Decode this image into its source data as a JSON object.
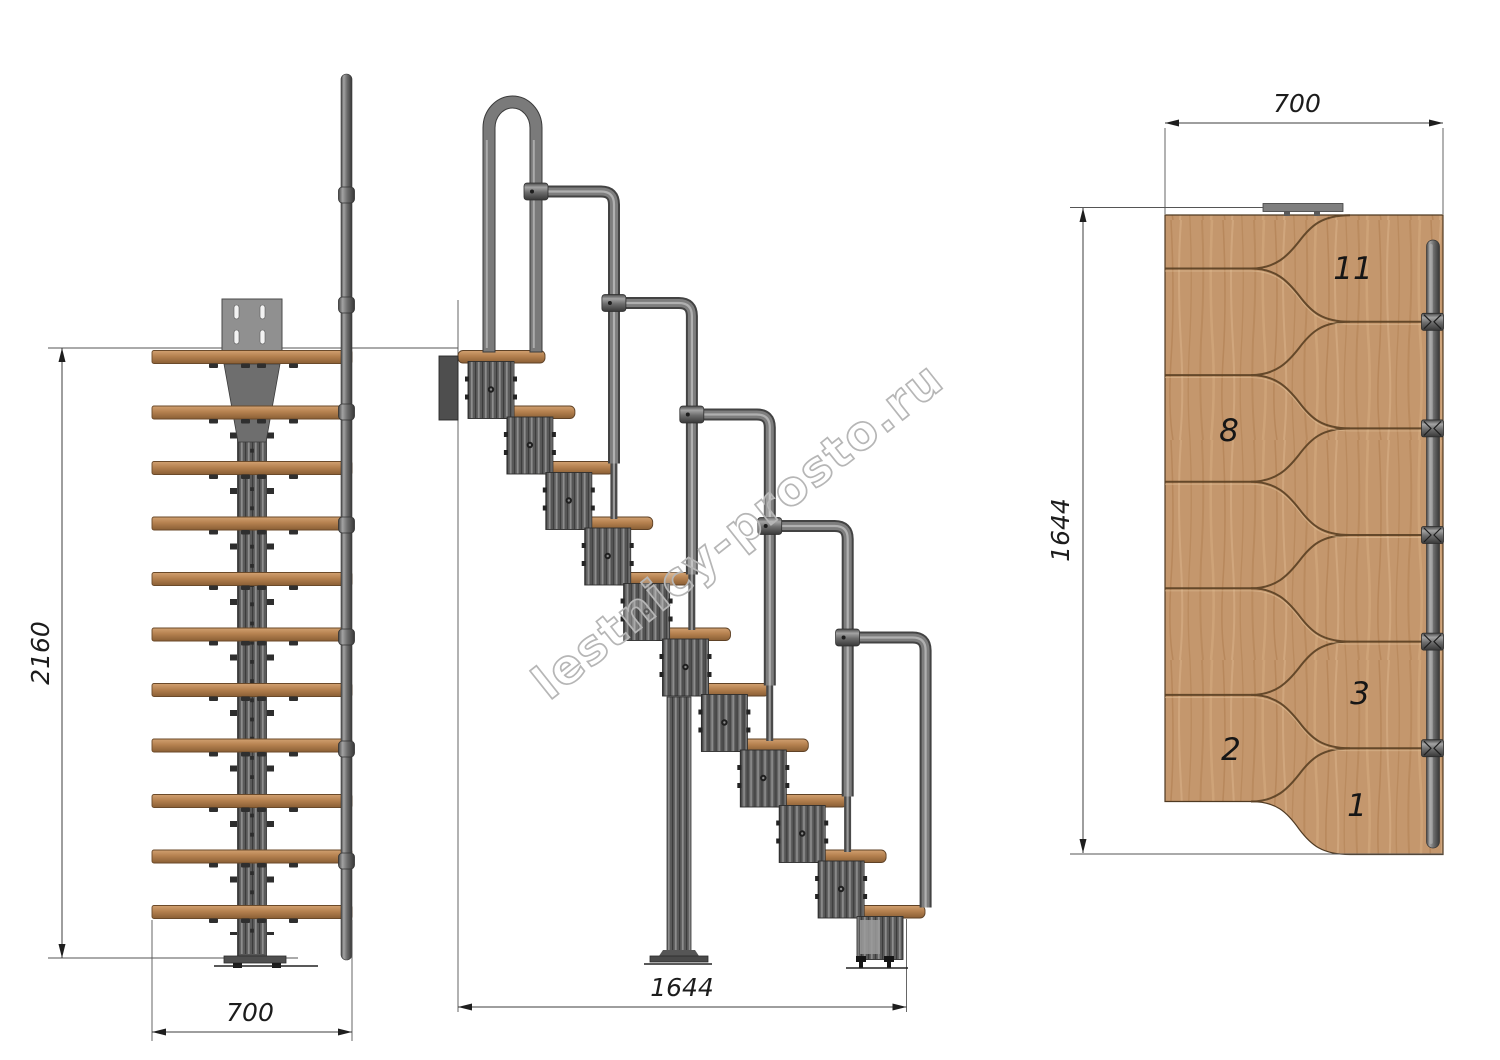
{
  "watermark": {
    "text": "lestnicy-prosto.ru"
  },
  "front_view": {
    "height_dim": "2160",
    "width_dim": "700"
  },
  "side_view": {
    "length_dim": "1644"
  },
  "plan_view": {
    "width_dim": "700",
    "length_dim": "1644",
    "tread_labels": [
      "11",
      "8",
      "3",
      "2",
      "1"
    ]
  }
}
